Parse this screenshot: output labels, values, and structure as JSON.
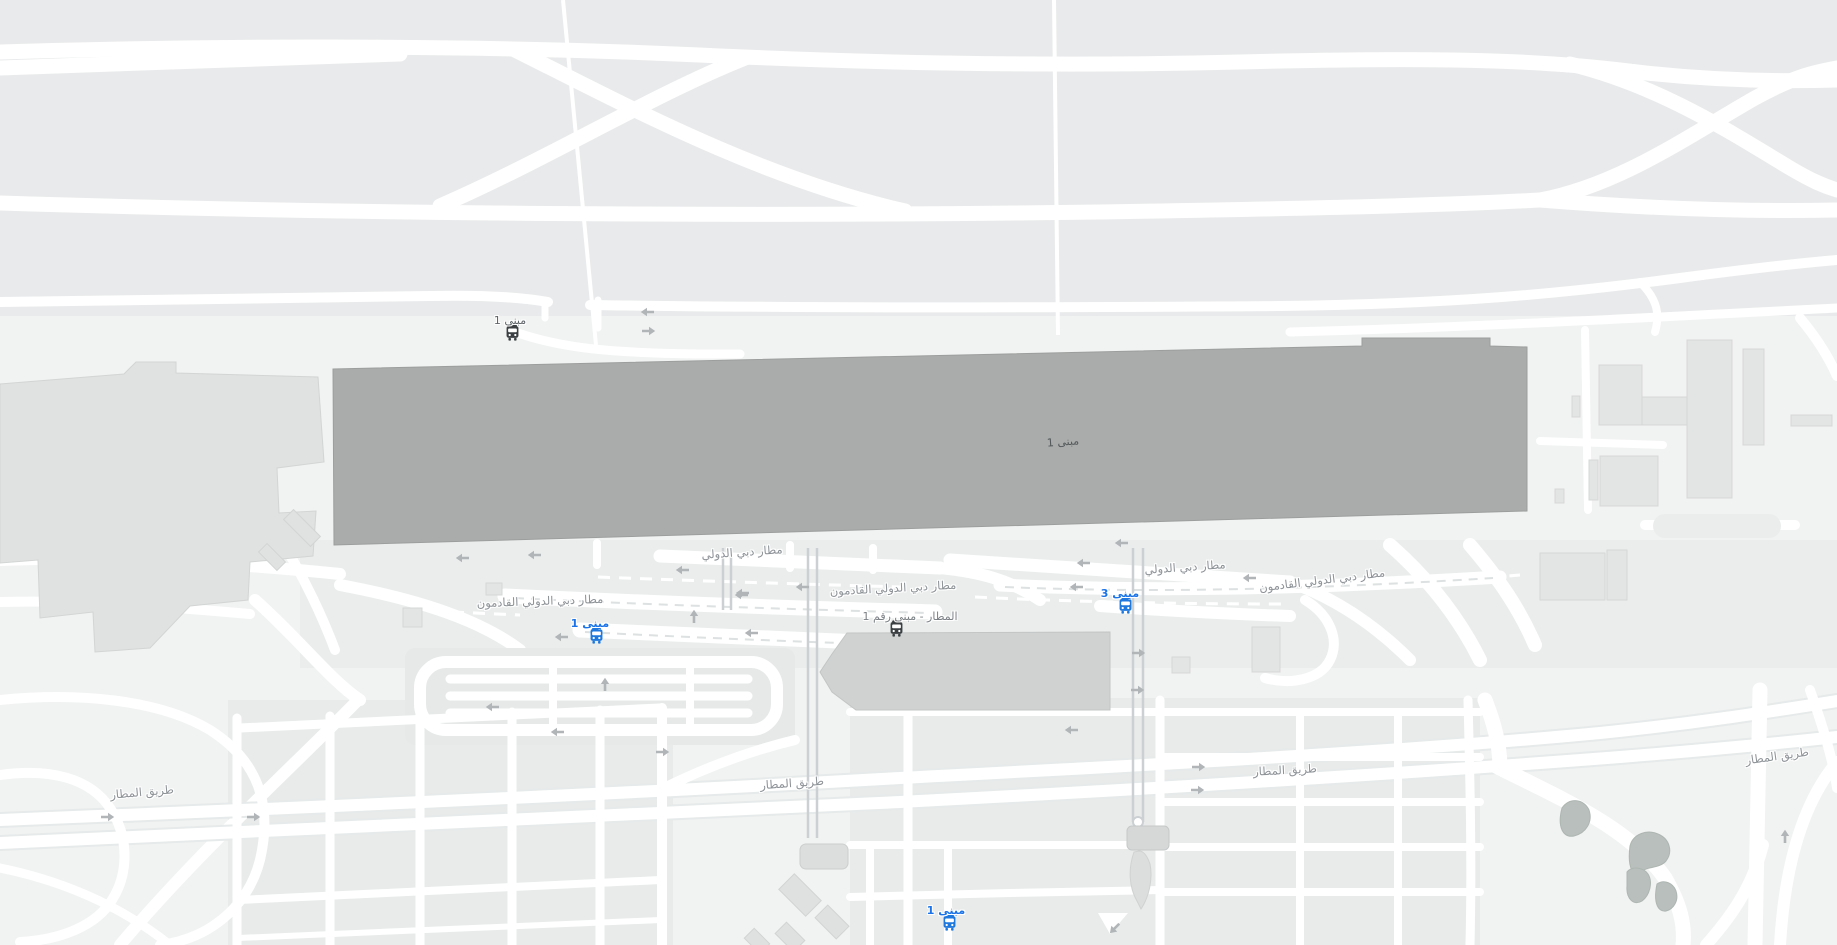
{
  "map": {
    "style": "light-roadmap",
    "terminal_building": {
      "label": "مبنى 1"
    },
    "road_labels": [
      {
        "text": "مطار دبي الدولي",
        "x": 742,
        "y": 552,
        "rot": -4
      },
      {
        "text": "مطار دبي الدولي القادمون",
        "x": 893,
        "y": 588,
        "rot": -3
      },
      {
        "text": "مطار دبي الدولي",
        "x": 1185,
        "y": 567,
        "rot": -4
      },
      {
        "text": "مطار دبي الدولي القادمون",
        "x": 1322,
        "y": 580,
        "rot": -7
      },
      {
        "text": "مطار دبي الدولي القادمون",
        "x": 540,
        "y": 601,
        "rot": -2
      },
      {
        "text": "طريق المطار",
        "x": 142,
        "y": 792,
        "rot": -5
      },
      {
        "text": "طريق المطار",
        "x": 792,
        "y": 783,
        "rot": -4
      },
      {
        "text": "طريق المطار",
        "x": 1285,
        "y": 770,
        "rot": -3
      },
      {
        "text": "طريق المطار",
        "x": 1777,
        "y": 756,
        "rot": -8
      }
    ],
    "bus_stops": [
      {
        "label": "مبنى 1",
        "icon": "bus-icon",
        "variant": "dark",
        "x": 512,
        "y": 333,
        "dx": -2,
        "label_color": "#5f6468"
      },
      {
        "label": "مبنى 1",
        "icon": "bus-icon",
        "variant": "blue",
        "x": 596,
        "y": 636,
        "dx": -6
      },
      {
        "label": "مبنى 3",
        "icon": "bus-icon",
        "variant": "blue",
        "x": 1125,
        "y": 606,
        "dx": -5
      },
      {
        "label": "مبنى 1",
        "icon": "bus-icon",
        "variant": "blue",
        "x": 949,
        "y": 923,
        "dx": -3
      },
      {
        "label": "المطار - مبنى رقم 1",
        "icon": "bus-icon",
        "variant": "dark",
        "x": 896,
        "y": 629,
        "dx": 14,
        "label_color": "#7b8085"
      }
    ],
    "arrows": [
      {
        "x": 648,
        "y": 312,
        "deg": 180
      },
      {
        "x": 648,
        "y": 331,
        "deg": 0
      },
      {
        "x": 463,
        "y": 558,
        "deg": 180
      },
      {
        "x": 535,
        "y": 555,
        "deg": 180
      },
      {
        "x": 683,
        "y": 570,
        "deg": 180
      },
      {
        "x": 742,
        "y": 595,
        "deg": 180
      },
      {
        "x": 803,
        "y": 587,
        "deg": 180
      },
      {
        "x": 694,
        "y": 617,
        "deg": 270
      },
      {
        "x": 562,
        "y": 637,
        "deg": 180
      },
      {
        "x": 743,
        "y": 593,
        "deg": 180
      },
      {
        "x": 752,
        "y": 633,
        "deg": 180
      },
      {
        "x": 605,
        "y": 685,
        "deg": 270
      },
      {
        "x": 493,
        "y": 707,
        "deg": 180
      },
      {
        "x": 558,
        "y": 732,
        "deg": 180
      },
      {
        "x": 1122,
        "y": 543,
        "deg": 180
      },
      {
        "x": 1084,
        "y": 563,
        "deg": 180
      },
      {
        "x": 1077,
        "y": 587,
        "deg": 180
      },
      {
        "x": 1250,
        "y": 578,
        "deg": 180
      },
      {
        "x": 1138,
        "y": 653,
        "deg": 0
      },
      {
        "x": 1137,
        "y": 690,
        "deg": 0
      },
      {
        "x": 1072,
        "y": 730,
        "deg": 180
      },
      {
        "x": 662,
        "y": 752,
        "deg": 0
      },
      {
        "x": 107,
        "y": 817,
        "deg": 0
      },
      {
        "x": 253,
        "y": 817,
        "deg": 0
      },
      {
        "x": 1198,
        "y": 767,
        "deg": 0
      },
      {
        "x": 1197,
        "y": 790,
        "deg": 0
      },
      {
        "x": 1785,
        "y": 837,
        "deg": 270
      },
      {
        "x": 1115,
        "y": 928,
        "deg": 135
      }
    ],
    "colors": {
      "land": "#f1f2f2",
      "apron": "#e9eaeb",
      "road_white": "#ffffff",
      "terminal_fill": "#aaacab",
      "building_light": "#e1e3e2",
      "building_mid": "#d0d2d2",
      "vegetation": "#b8bfbc",
      "label_gray": "#8d9297",
      "bus_blue": "#1e78dd",
      "bus_blue_label": "#1a73e8",
      "bus_dark": "#3c4043"
    }
  }
}
